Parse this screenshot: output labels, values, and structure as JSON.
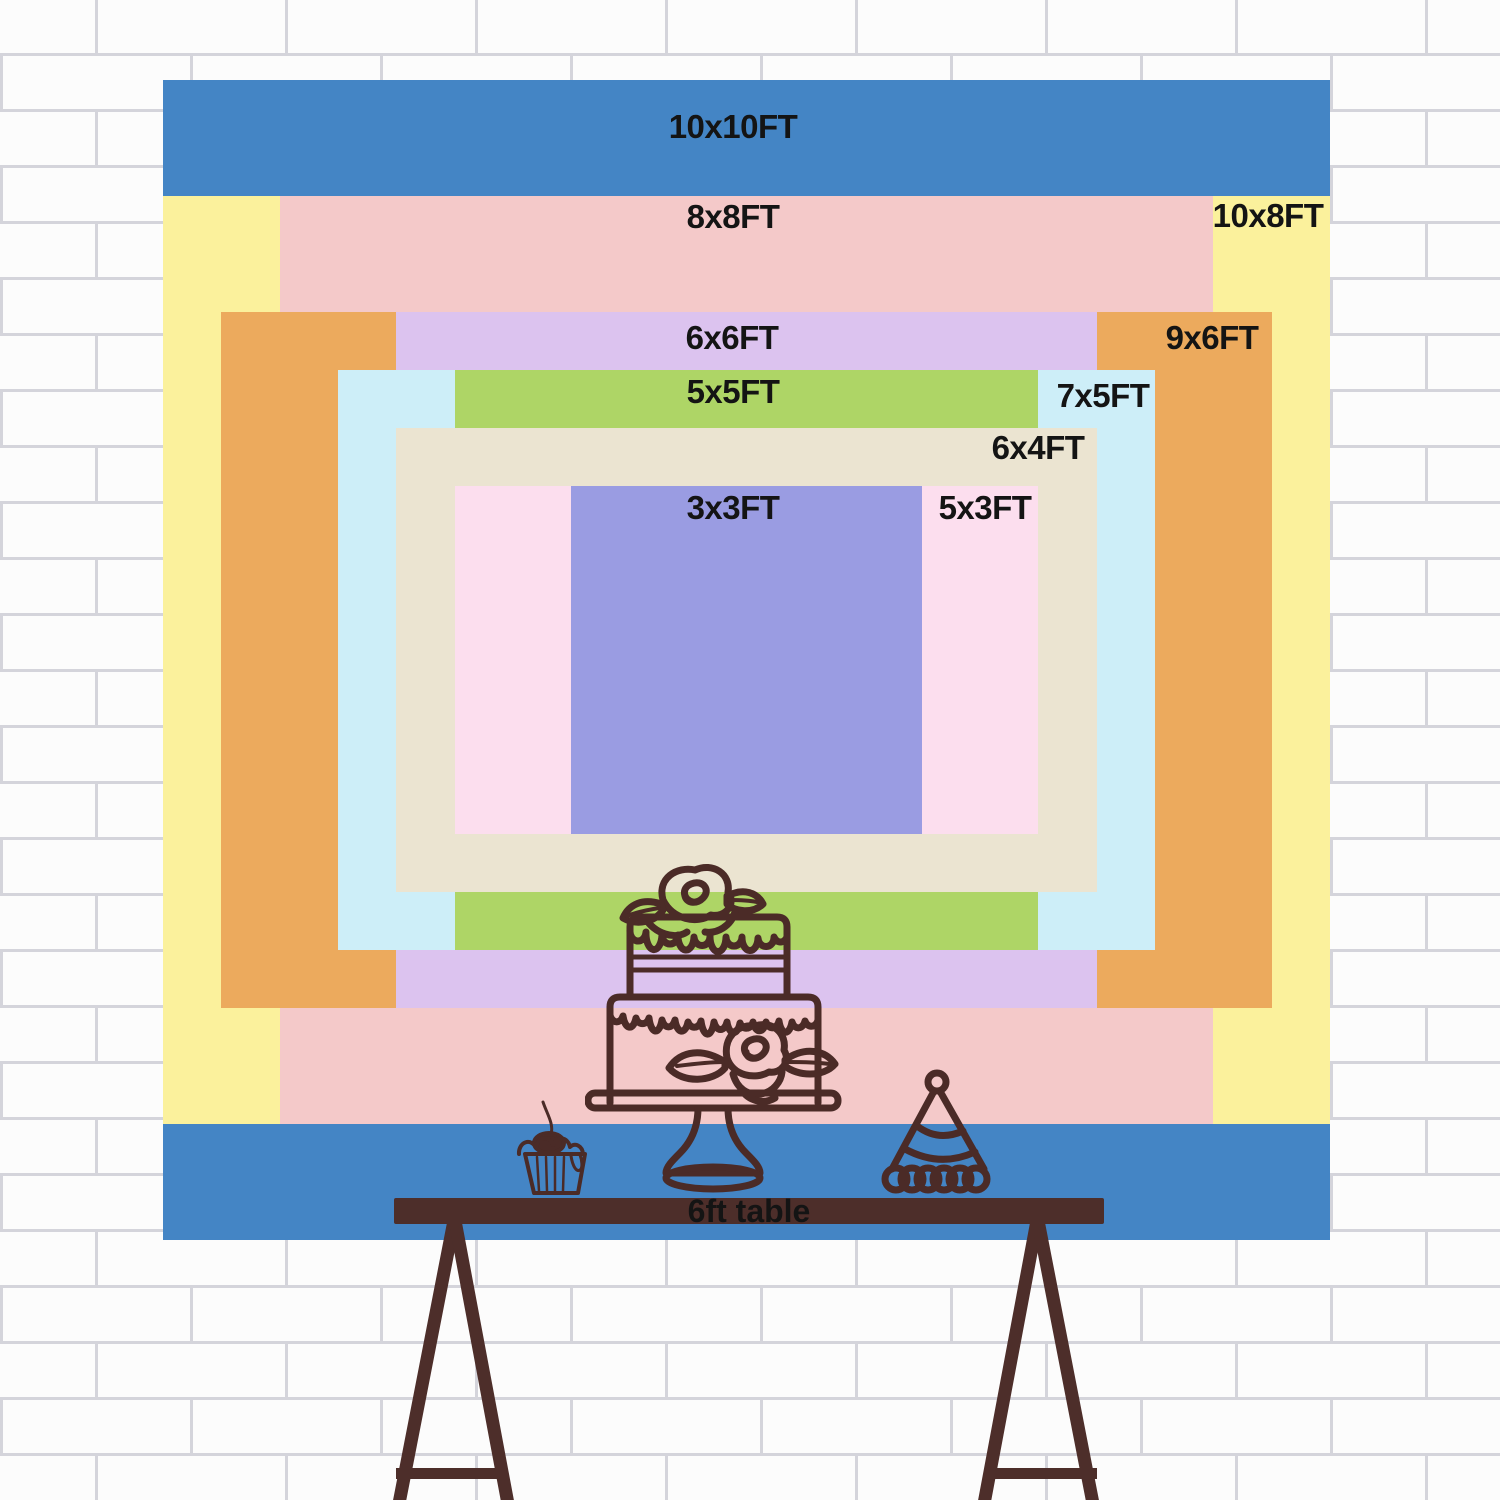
{
  "scene": {
    "wall_color": "#fbfbfc",
    "mortar_color": "#c6c6d0"
  },
  "backdrop": {
    "center_x": 746.5,
    "center_y": 660,
    "px_per_ft_x": 116.7,
    "px_per_ft_y": 116,
    "sizes": [
      {
        "label": "10x10FT",
        "width_ft": 10,
        "height_ft": 10,
        "color": "#4485c5",
        "label_x": 733,
        "label_y": 127
      },
      {
        "label": "10x8FT",
        "width_ft": 10,
        "height_ft": 8,
        "color": "#fbf19c",
        "label_x": 1268,
        "label_y": 216
      },
      {
        "label": "8x8FT",
        "width_ft": 8,
        "height_ft": 8,
        "color": "#f4c9c9",
        "label_x": 733,
        "label_y": 217
      },
      {
        "label": "9x6FT",
        "width_ft": 9,
        "height_ft": 6,
        "color": "#ecaa5d",
        "label_x": 1212,
        "label_y": 338
      },
      {
        "label": "6x6FT",
        "width_ft": 6,
        "height_ft": 6,
        "color": "#dcc3ef",
        "label_x": 732,
        "label_y": 338
      },
      {
        "label": "7x5FT",
        "width_ft": 7,
        "height_ft": 5,
        "color": "#cdeef8",
        "label_x": 1103,
        "label_y": 396
      },
      {
        "label": "5x5FT",
        "width_ft": 5,
        "height_ft": 5,
        "color": "#aed566",
        "label_x": 733,
        "label_y": 392
      },
      {
        "label": "6x4FT",
        "width_ft": 6,
        "height_ft": 4,
        "color": "#ebe4d1",
        "label_x": 1038,
        "label_y": 448
      },
      {
        "label": "5x3FT",
        "width_ft": 5,
        "height_ft": 3,
        "color": "#fcdeee",
        "label_x": 985,
        "label_y": 508
      },
      {
        "label": "3x3FT",
        "width_ft": 3,
        "height_ft": 3,
        "color": "#9a9ce2",
        "label_x": 733,
        "label_y": 508
      }
    ],
    "label_color": "#141414"
  },
  "table": {
    "label": "6ft table",
    "color": "#4d2e2a",
    "text_color": "#141414"
  },
  "drawings": {
    "ink_color": "#4b2b27",
    "cherry_highlight_color": "#4e87c4",
    "items": [
      "two-tier-cake-on-stand",
      "cupcake-with-cherry",
      "party-hat"
    ]
  }
}
